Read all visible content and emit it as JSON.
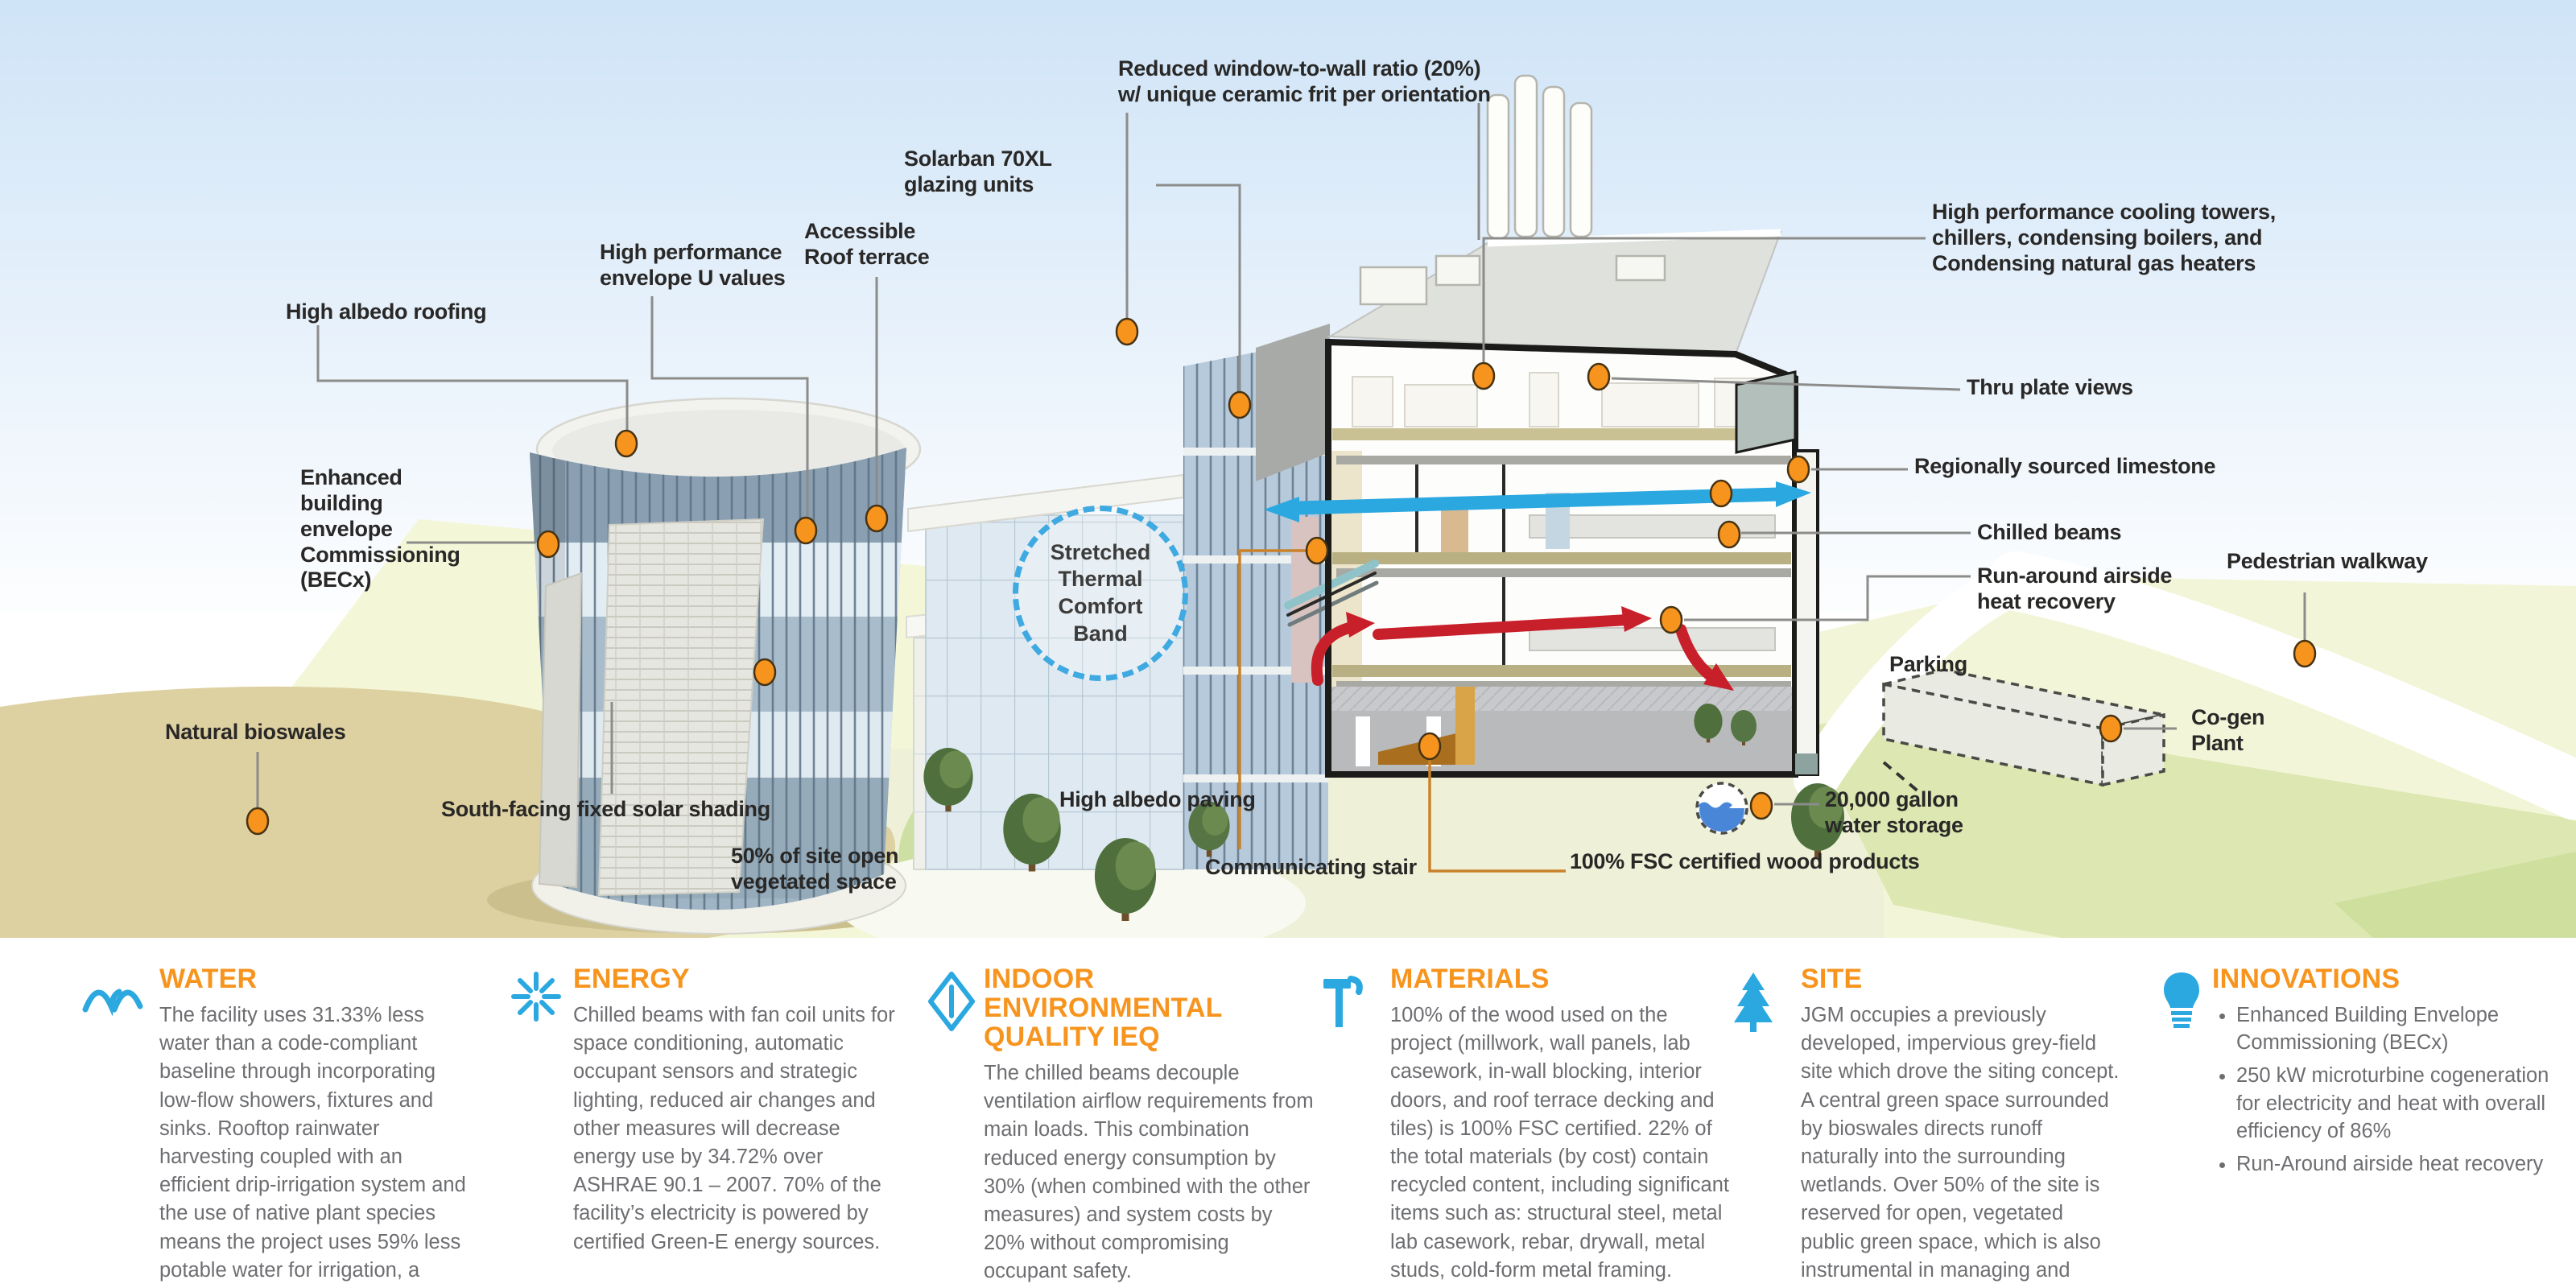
{
  "scene": {
    "callouts": {
      "reduced_window": {
        "text": "Reduced window-to-wall ratio (20%)\nw/ unique ceramic frit per orientation"
      },
      "solarban": {
        "text": "Solarban 70XL\nglazing units"
      },
      "accessible_roof": {
        "text": "Accessible\nRoof terrace"
      },
      "high_perf_envelope": {
        "text": "High performance\nenvelope U values"
      },
      "high_albedo_roofing": {
        "text": "High albedo roofing"
      },
      "becx": {
        "text": "Enhanced\nbuilding\nenvelope\nCommissioning\n(BECx)"
      },
      "natural_bioswales": {
        "text": "Natural bioswales"
      },
      "south_facing": {
        "text": "South-facing fixed solar shading"
      },
      "fifty_percent": {
        "text": "50% of site open\nvegetated space"
      },
      "high_albedo_paving": {
        "text": "High albedo paving"
      },
      "communicating_stair": {
        "text": "Communicating stair"
      },
      "fsc_wood": {
        "text": "100% FSC certified wood products"
      },
      "water_storage": {
        "text": "20,000 gallon\nwater storage"
      },
      "parking": {
        "text": "Parking"
      },
      "cogen": {
        "text": "Co-gen\nPlant"
      },
      "cooling_towers": {
        "text": "High performance cooling towers,\nchillers, condensing boilers, and\nCondensing natural gas heaters"
      },
      "thru_plate": {
        "text": "Thru plate views"
      },
      "limestone": {
        "text": "Regionally sourced limestone"
      },
      "chilled_beams": {
        "text": "Chilled beams"
      },
      "run_around": {
        "text": "Run-around airside\nheat recovery"
      },
      "pedestrian": {
        "text": "Pedestrian walkway"
      },
      "thermal_band": {
        "text": "Stretched\nThermal\nComfort\nBand"
      }
    }
  },
  "legend": {
    "sections": {
      "water": {
        "title": "WATER",
        "body": "The facility uses 31.33% less water than a code-compliant baseline through incorporating low-flow showers, fixtures and sinks. Rooftop rainwater harvesting coupled with an efficient drip-irrigation system and the use of native plant species means the project uses 59% less potable water for irrigation, a savings of 42,340 gallons/year."
      },
      "energy": {
        "title": "ENERGY",
        "body": "Chilled beams with fan coil units for space conditioning, automatic occupant sensors and strategic lighting, reduced air changes and other measures will decrease energy use by 34.72% over ASHRAE 90.1 – 2007. 70% of the facility’s electricity is powered by certified Green-E energy sources."
      },
      "ieq": {
        "title": "INDOOR ENVIRONMENTAL\nQUALITY IEQ",
        "body": "The chilled beams decouple ventilation airflow requirements from main loads. This combination reduced energy consumption by 30% (when combined with the other measures) and system costs by 20% without compromising occupant safety."
      },
      "materials": {
        "title": "MATERIALS",
        "body": "100% of the wood used on the project (millwork, wall panels, lab casework, in-wall blocking, interior doors, and roof terrace decking and tiles) is 100% FSC certified. 22% of the total materials (by cost) contain recycled content, including significant items such as: structural steel, metal lab casework, rebar, drywall, metal studs, cold-form metal framing."
      },
      "site": {
        "title": "SITE",
        "body": "JGM occupies a previously developed, impervious grey-field site which drove the siting concept. A central green space surrounded by bioswales directs runoff naturally into the surrounding wetlands. Over 50% of the site is reserved for open, vegetated public green space, which is also instrumental in managing and treating stormwater onsite."
      },
      "innovations": {
        "title": "INNOVATIONS",
        "bullets": [
          "Enhanced Building Envelope Commissioning (BECx)",
          "250 kW microturbine cogeneration for electricity and heat with overall efficiency of 86%",
          "Run-Around airside heat recovery"
        ]
      }
    }
  },
  "colors": {
    "accent_orange": "#F7941E",
    "icon_blue": "#2BA8E0",
    "body_gray": "#6D6E71",
    "marker_orange": "#F7941D",
    "arrow_red": "#C8202A",
    "arrow_cyan": "#2BA8E0",
    "sand": "#DDD1A1",
    "grass_green": "#CDDFA3"
  }
}
